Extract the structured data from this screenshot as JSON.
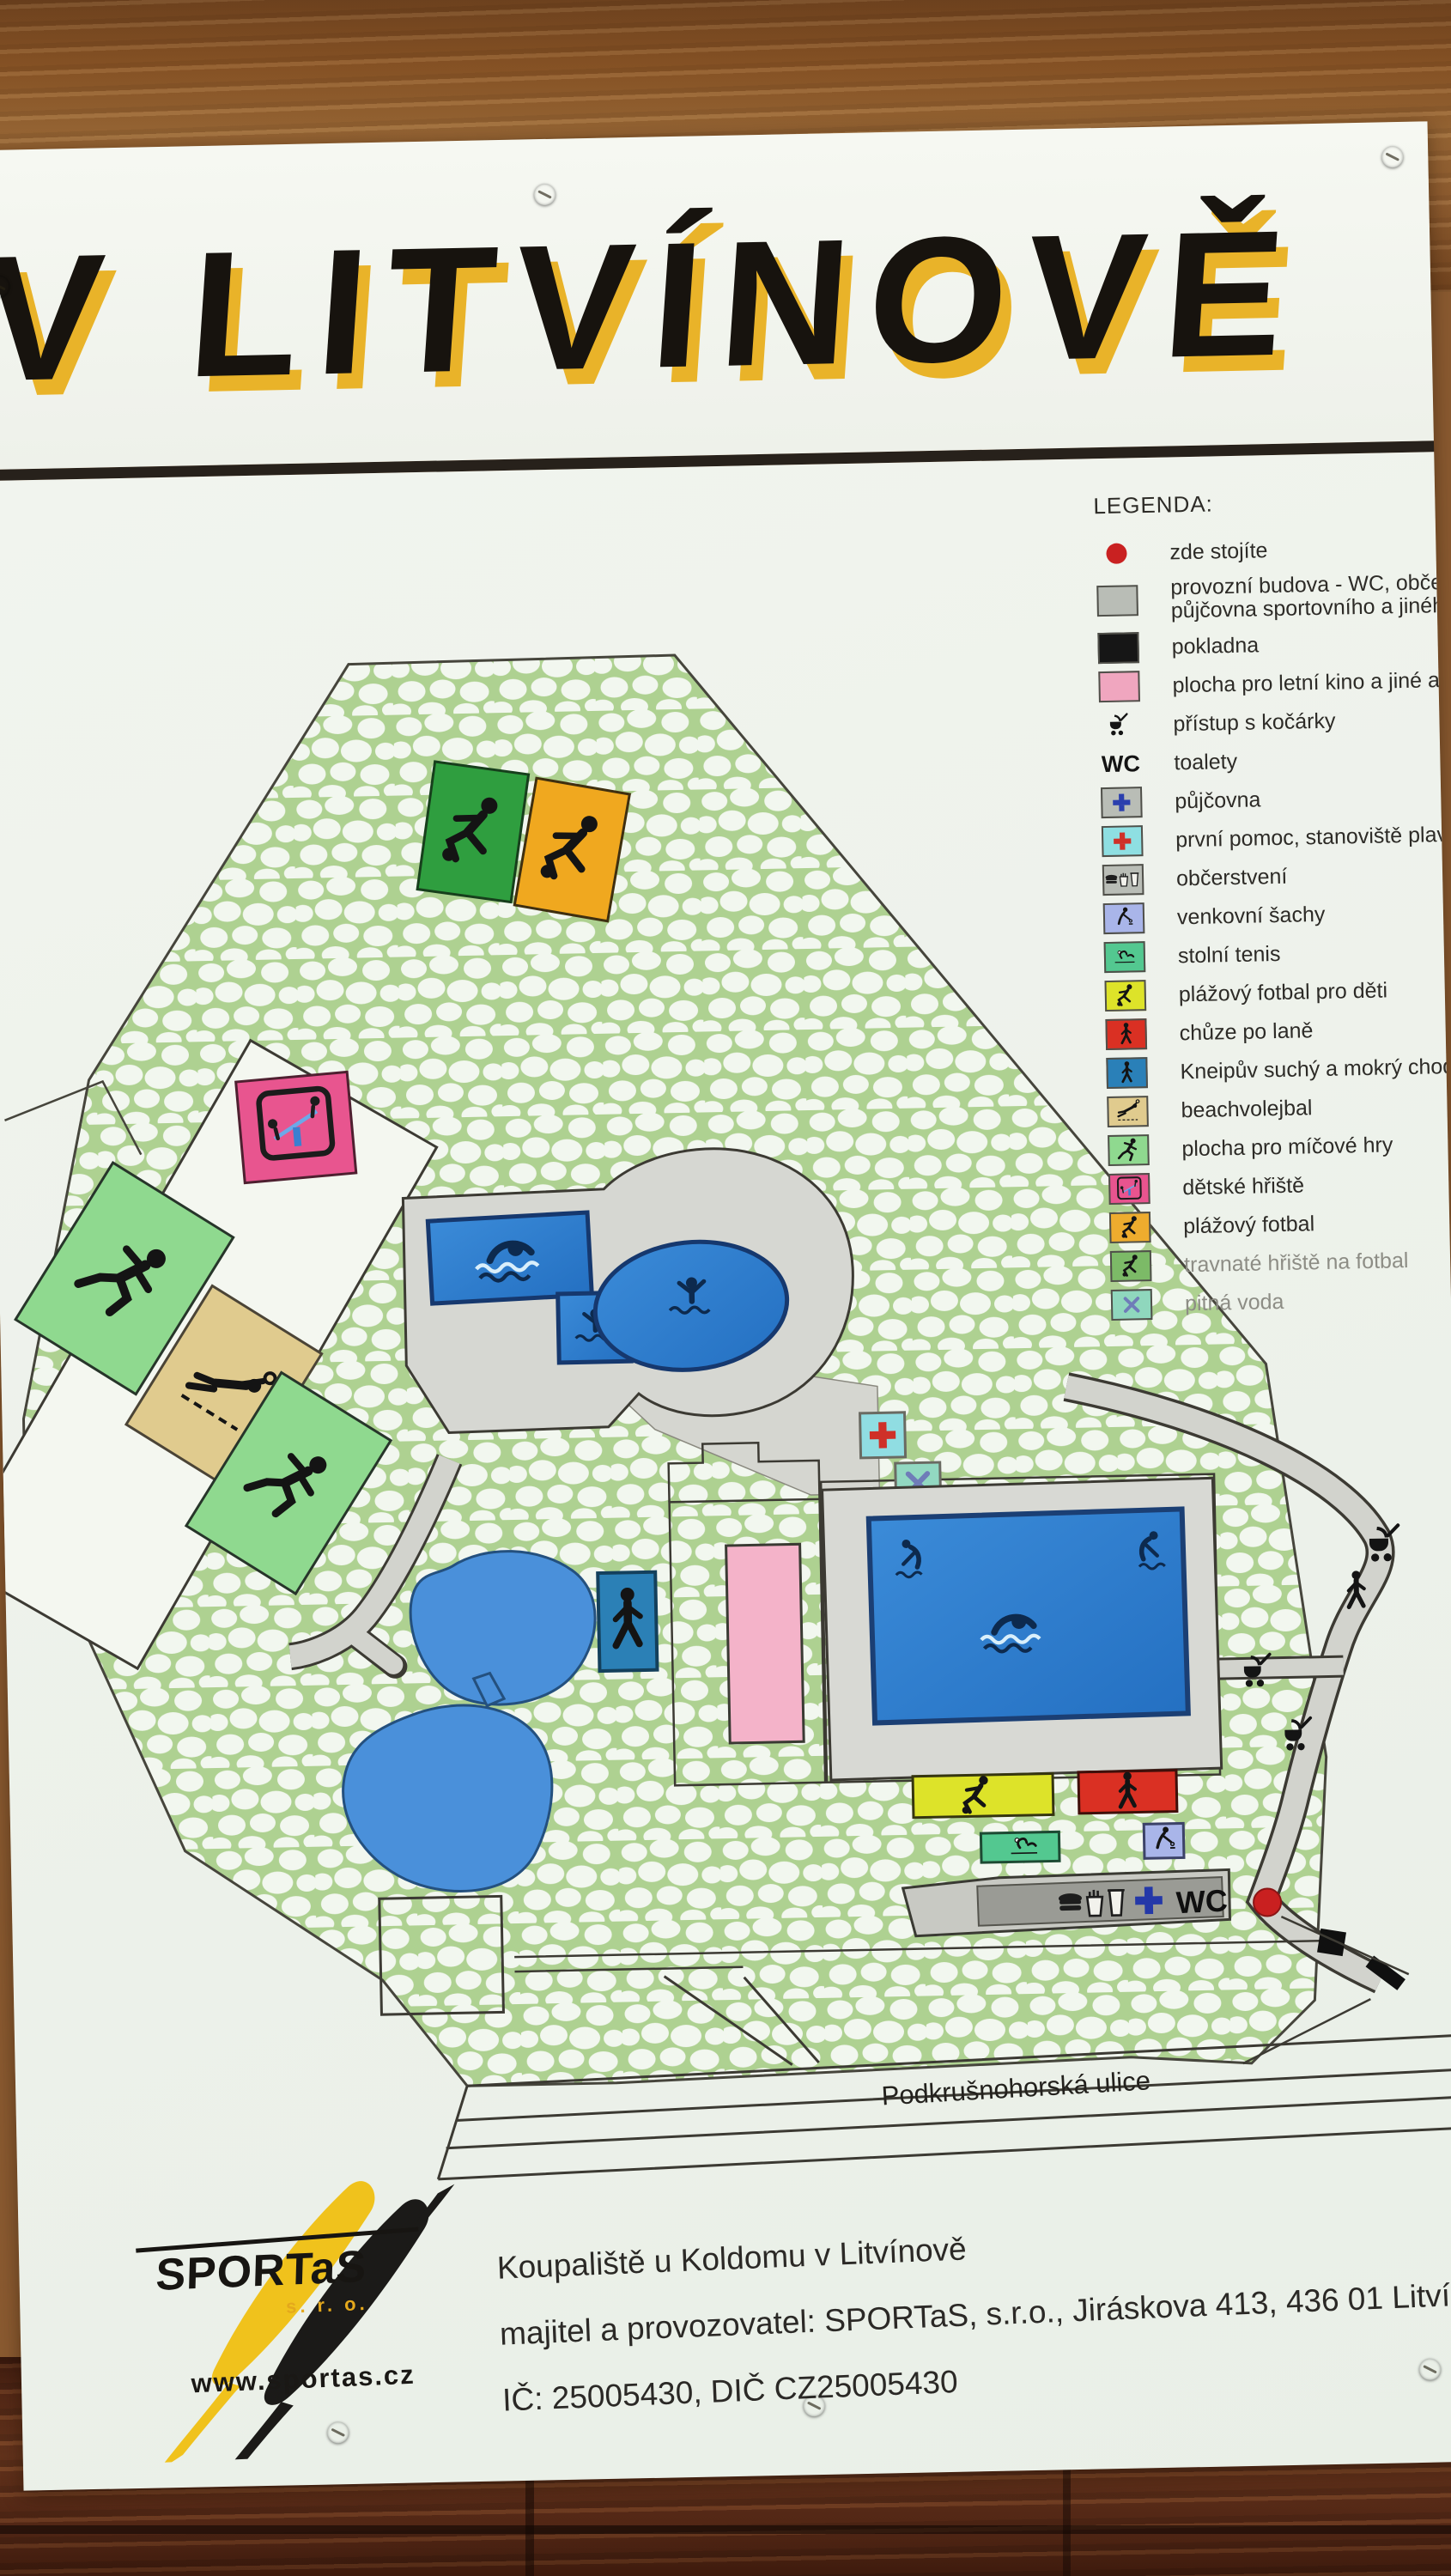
{
  "title": "V LITVÍNOVĚ",
  "legend": {
    "title": "LEGENDA:",
    "wc_glyph": "WC",
    "items": [
      {
        "label": "zde stojíte",
        "color": "#c92121"
      },
      {
        "label": "provozní budova - WC, občerstven",
        "label2": "půjčovna sportovního a jiného vyba",
        "color": "#b9bdb6"
      },
      {
        "label": "pokladna",
        "color": "#161616"
      },
      {
        "label": "plocha pro letní kino a jiné akce",
        "color": "#f0a6bf"
      },
      {
        "label": "přístup s kočárky"
      },
      {
        "label": "toalety"
      },
      {
        "label": "půjčovna",
        "color": "#b9bdb6"
      },
      {
        "label": "první pomoc, stanoviště plavčíků",
        "color": "#8edfe2"
      },
      {
        "label": "občerstvení",
        "color": "#b9bdb6"
      },
      {
        "label": "venkovní šachy",
        "color": "#a9b5e9"
      },
      {
        "label": "stolní tenis",
        "color": "#53c890"
      },
      {
        "label": "plážový fotbal pro děti",
        "color": "#dde329"
      },
      {
        "label": "chůze po laně",
        "color": "#da3023"
      },
      {
        "label": "Kneipův suchý a mokrý chodníček",
        "color": "#2a80b8"
      },
      {
        "label": "beachvolejbal",
        "color": "#e0cb8e"
      },
      {
        "label": "plocha pro míčové hry",
        "color": "#8fd98f"
      },
      {
        "label": "dětské hřiště",
        "color": "#e8548f"
      },
      {
        "label": "plážový fotbal",
        "color": "#eeac2e"
      },
      {
        "label": "travnaté hřiště na fotbal",
        "color": "#7cba67"
      },
      {
        "label": "pitná voda",
        "color": "#8fd7bd"
      }
    ]
  },
  "map": {
    "street_label": "Podkrušnohorská ulice",
    "building_label": "WC"
  },
  "footer": {
    "line1": "Koupaliště u Koldomu v Litvínově",
    "line2": "majitel a provozovatel: SPORTaS, s.r.o., Jiráskova 413, 436 01 Litvínov",
    "line3": "IČ: 25005430, DIČ CZ25005430"
  },
  "logo": {
    "name": "SPORTaS",
    "suffix": "s. r. o.",
    "web": "www.sportas.cz"
  },
  "palette": {
    "title_shadow": "#e9b329",
    "pool_blue": "#2e7fd0",
    "pond_blue": "#4a90da",
    "pebble_green": "#aed191",
    "path_gray": "#d2d3cd",
    "wood_top": "#9c6a37",
    "wood_bottom": "#5d2f1a",
    "you_are_here": "#c92121"
  }
}
